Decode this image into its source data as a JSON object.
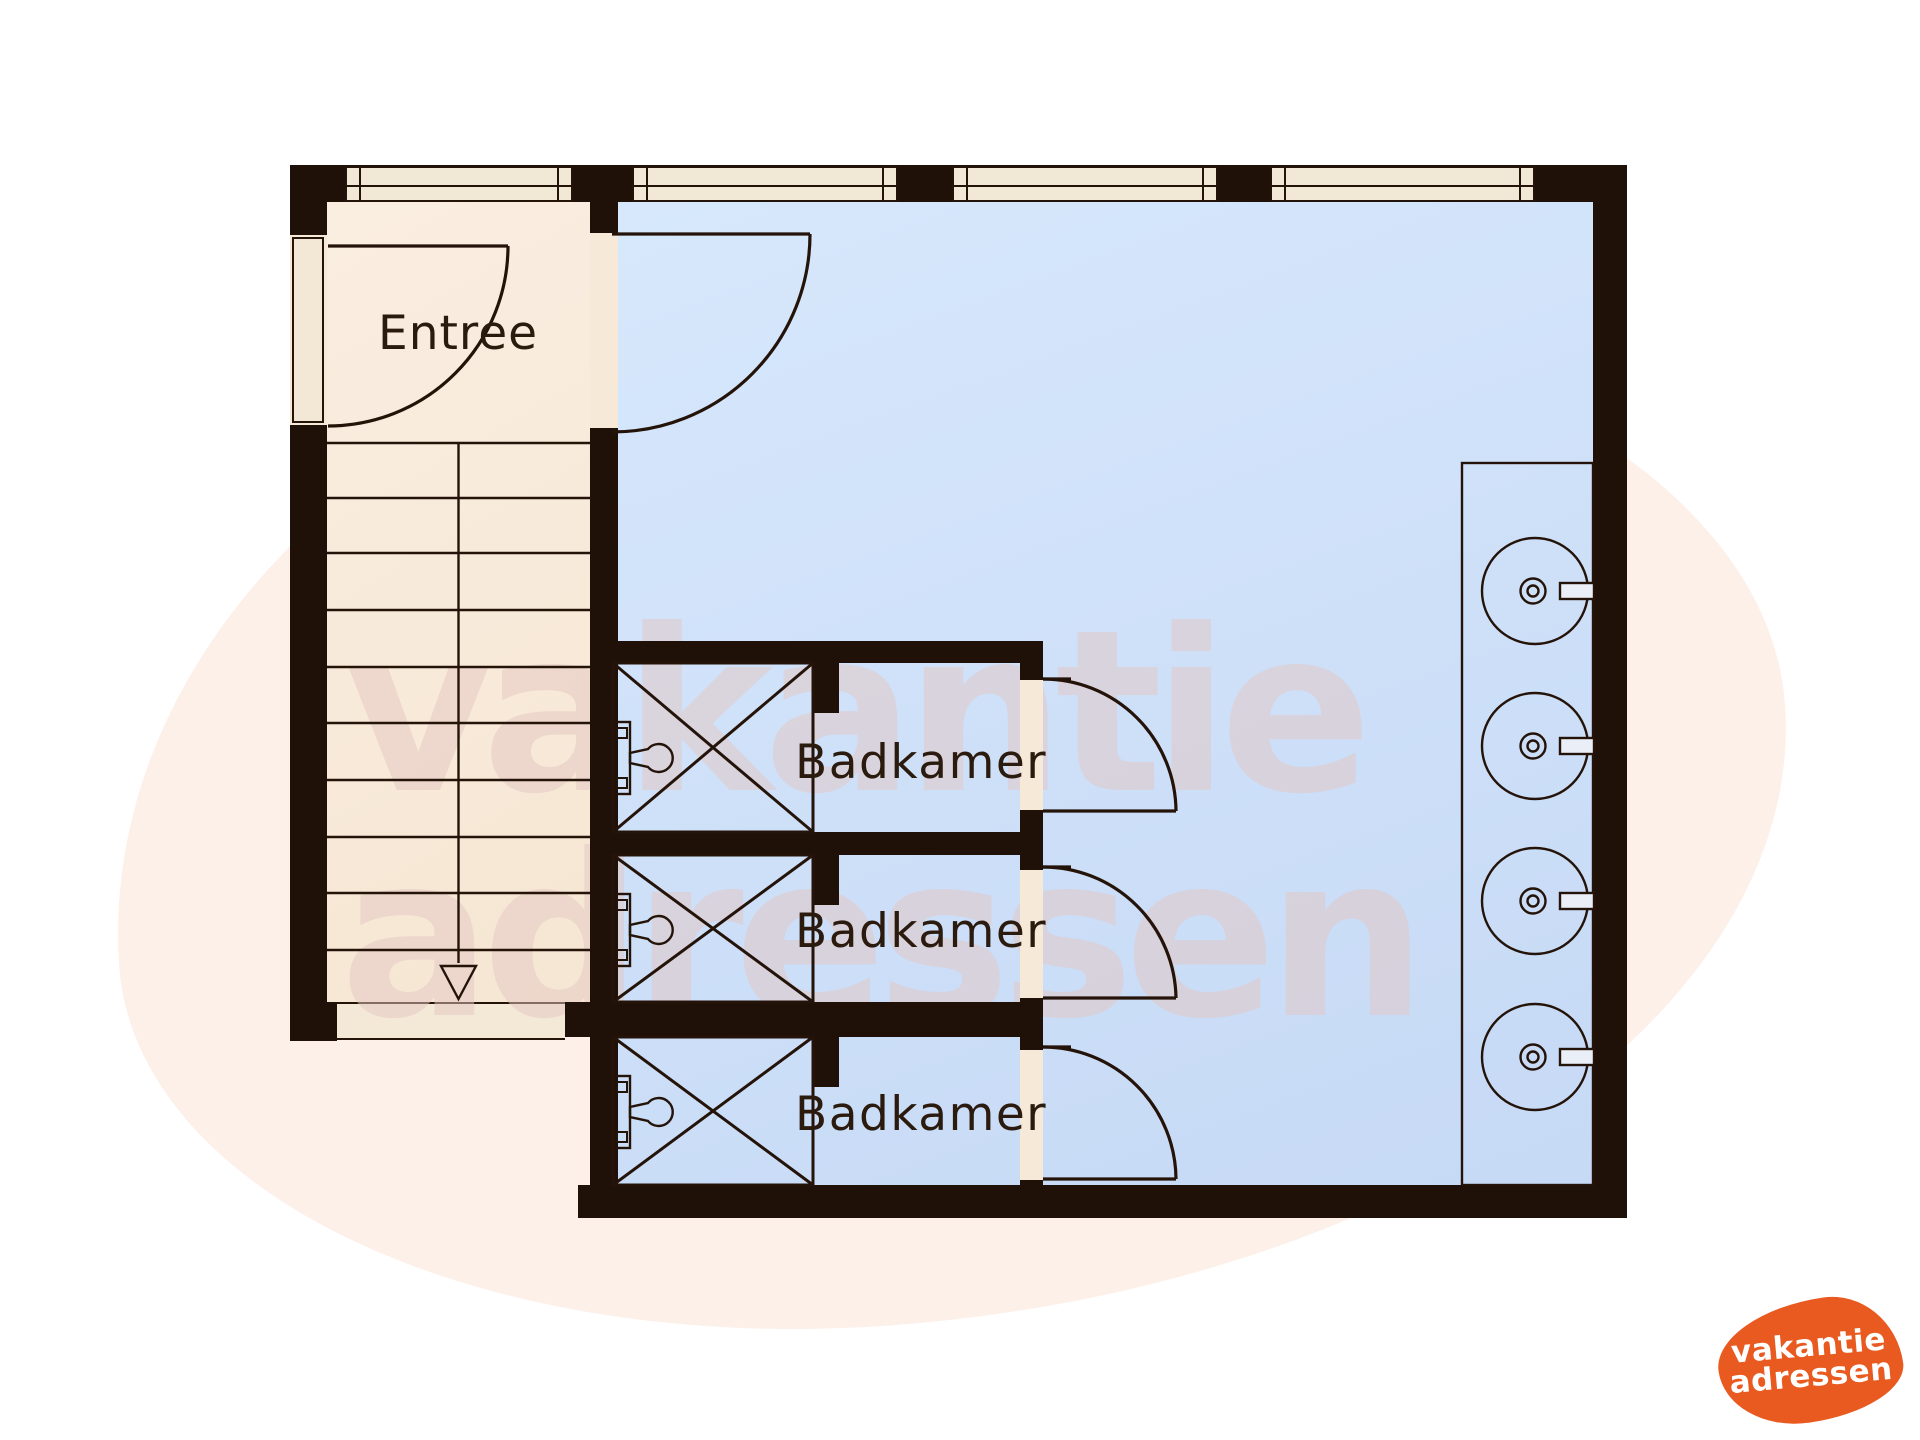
{
  "plan": {
    "rooms": [
      {
        "label": "Entree"
      },
      {
        "label": "Badkamer"
      },
      {
        "label": "Badkamer"
      },
      {
        "label": "Badkamer"
      }
    ],
    "fixtures": {
      "staircase": "stairs-down-arrow",
      "showers": 3,
      "washbasins": 4,
      "windows": 4,
      "door_swings": 5
    }
  },
  "watermark": {
    "line1": "vakantie",
    "line2": "adressen"
  },
  "logo": {
    "line1": "vakantie",
    "line2": "adressen"
  },
  "colors": {
    "wall": "#1f1008",
    "line": "#241309",
    "floor_hall": "#f9ecde",
    "floor_main": "#cddff7",
    "window_fill": "#f1e8d6",
    "door_opening": "#f6e9d8",
    "logo_orange": "#e85a20",
    "blob_pink": "#fcf0e9",
    "watermark_tint": "rgba(228,198,194,0.5)"
  }
}
